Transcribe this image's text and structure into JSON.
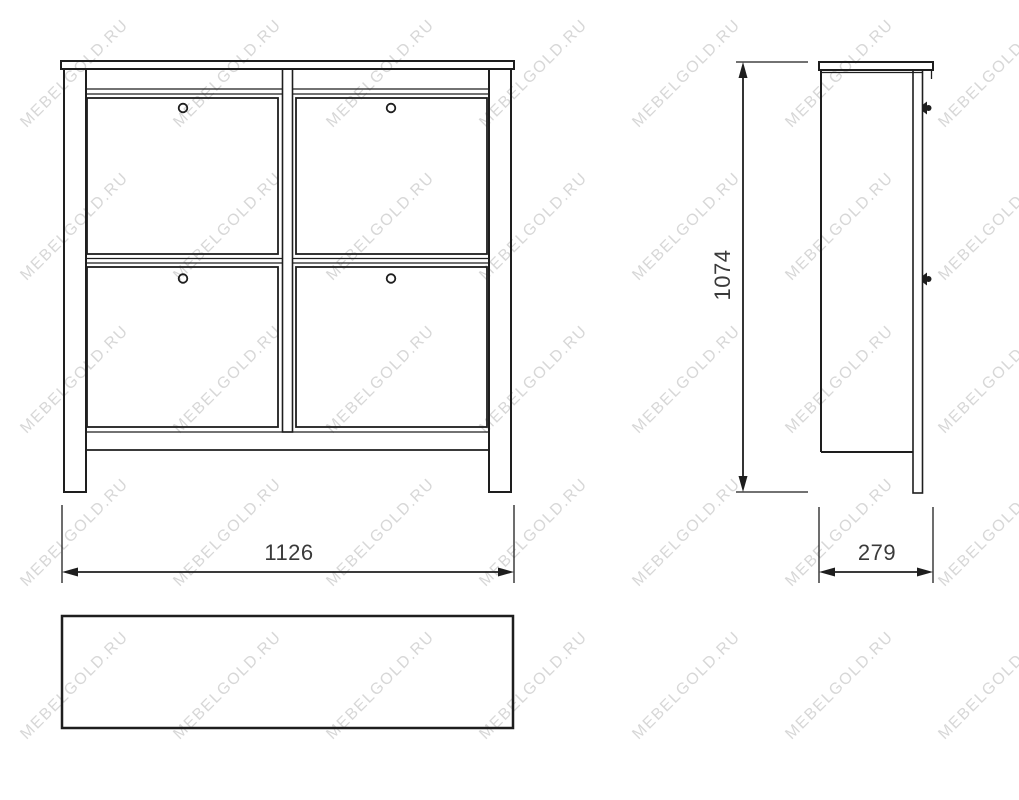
{
  "theme": {
    "background": "#ffffff",
    "line_color": "#1e1e1e",
    "dimension_text_color": "#3a3a3a"
  },
  "watermark": {
    "text": "MEBELGOLD.RU",
    "color": "#d7d7d7",
    "font_size_px": 16,
    "rotation_deg": -45,
    "grid": {
      "start_x": 75,
      "start_y": 74,
      "step_x": 153,
      "step_y": 153,
      "cols": 7,
      "rows": 5
    }
  },
  "drawing": {
    "dimensions": {
      "width_mm": "1126",
      "height_mm": "1074",
      "depth_mm": "279"
    }
  }
}
